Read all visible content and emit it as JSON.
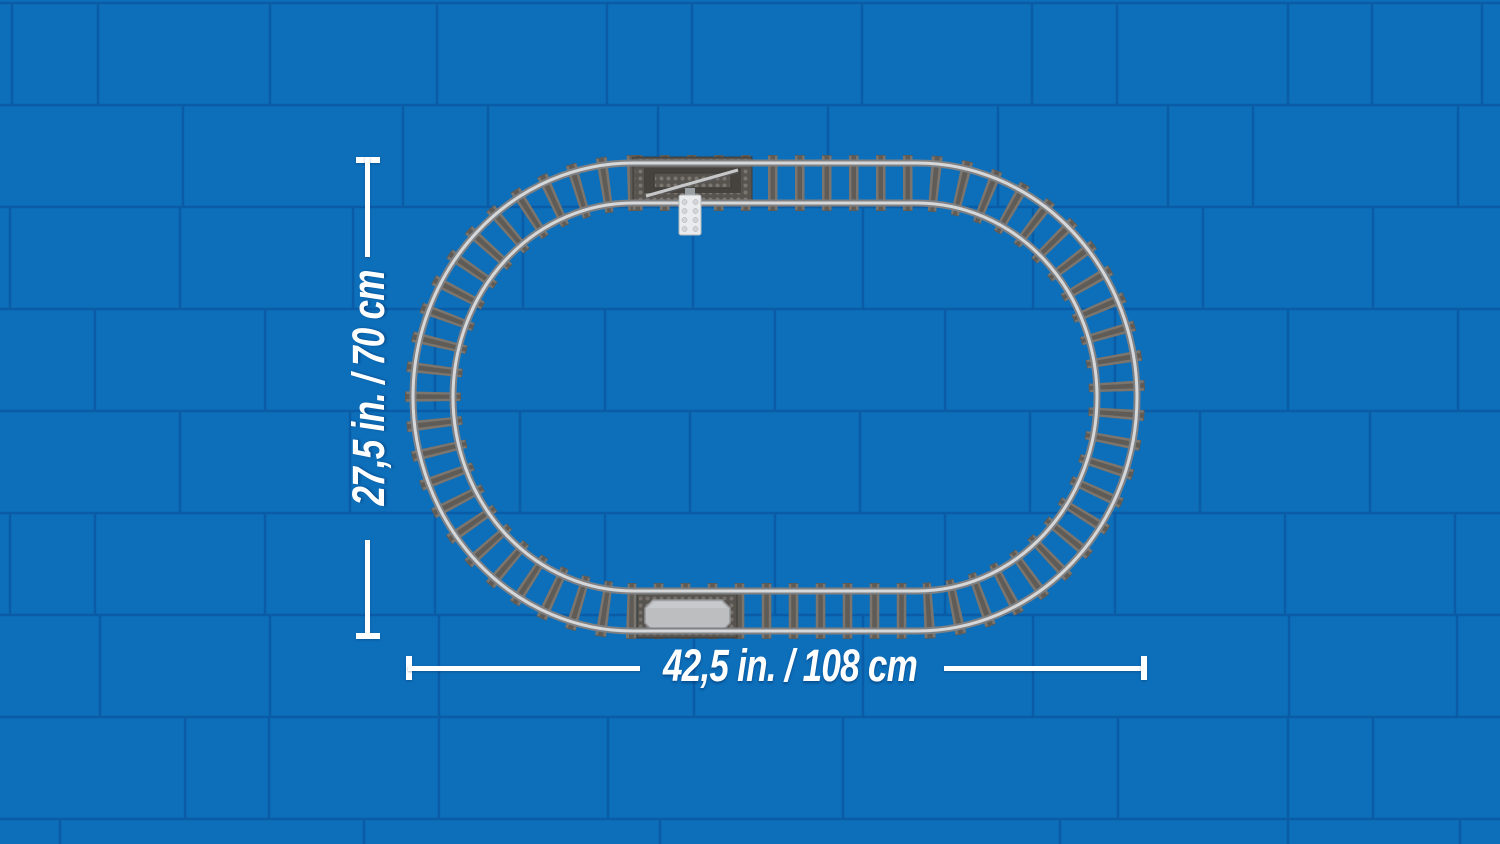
{
  "annotations": {
    "height_label": "27,5 in. / 70 cm",
    "width_label": "42,5 in. / 108 cm"
  },
  "scene": {
    "background": "blue-brick-wall",
    "subject": "lego-train-track-oval-top-view",
    "special_pieces": [
      "switch-track-with-white-lever",
      "stop-track-plate"
    ]
  },
  "colors": {
    "wall_brick": "#0d6fba",
    "wall_mortar": "#0a5ca6",
    "sleeper": "#5f5b56",
    "sleeper_highlight": "#8e877f",
    "rail_dark": "#7e8083",
    "rail_light": "#d6d7d9",
    "plate_dark": "#57534e",
    "plate_recess": "#46423e",
    "stud": "#8a847d",
    "stop_plate": "#bdbec0",
    "lever_white": "#e9ebed",
    "annotation_white": "#ffffff"
  }
}
